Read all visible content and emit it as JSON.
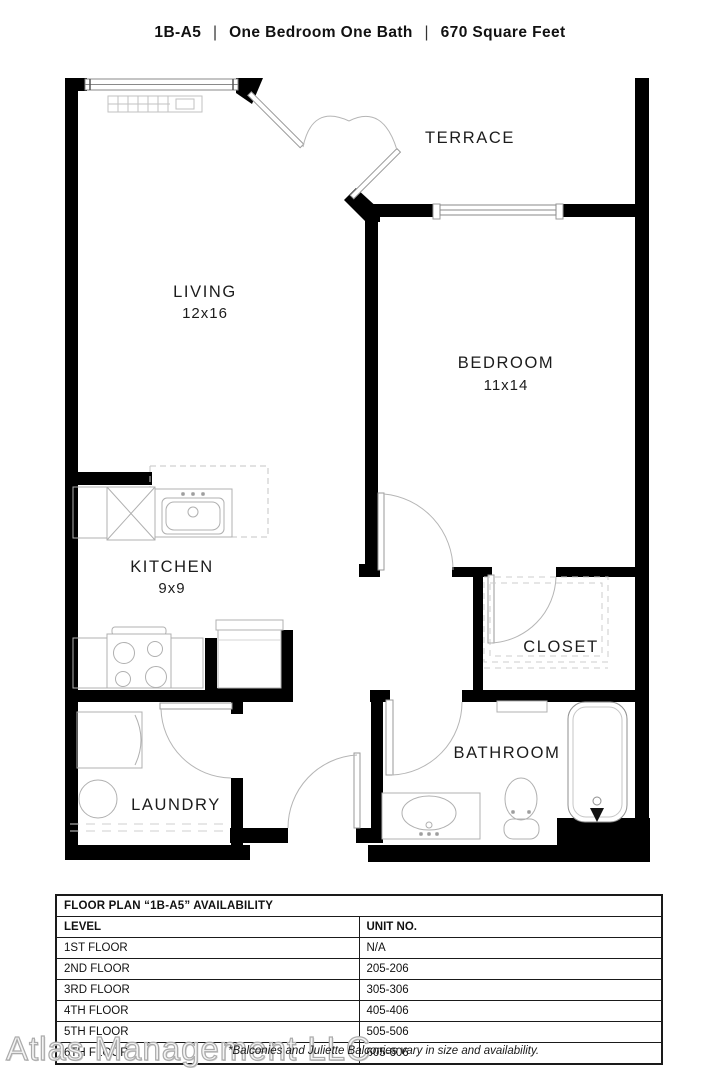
{
  "header": {
    "unit": "1B-A5",
    "separator": "|",
    "descriptor": "One Bedroom One Bath",
    "sqft": "670 Square Feet"
  },
  "floor_plan": {
    "terrace": {
      "name": "TERRACE"
    },
    "living": {
      "name": "LIVING",
      "dims": "12x16"
    },
    "bedroom": {
      "name": "BEDROOM",
      "dims": "11x14"
    },
    "kitchen": {
      "name": "KITCHEN",
      "dims": "9x9"
    },
    "closet": {
      "name": "CLOSET"
    },
    "bathroom": {
      "name": "BATHROOM"
    },
    "laundry": {
      "name": "LAUNDRY"
    },
    "wall_color": "#000000",
    "fixture_line_color": "#b0b0b0",
    "door_arc_color": "#aaaaaa"
  },
  "availability_table": {
    "title": "FLOOR PLAN “1B-A5” AVAILABILITY",
    "columns": [
      "LEVEL",
      "UNIT NO."
    ],
    "rows": [
      {
        "level": "1ST FLOOR",
        "unit": "N/A"
      },
      {
        "level": "2ND FLOOR",
        "unit": "205-206"
      },
      {
        "level": "3RD FLOOR",
        "unit": "305-306"
      },
      {
        "level": "4TH FLOOR",
        "unit": "405-406"
      },
      {
        "level": "5TH FLOOR",
        "unit": "505-506"
      },
      {
        "level": "6TH FLOOR",
        "unit": "605-606"
      }
    ]
  },
  "footer": {
    "watermark": "Atlas Management LLC",
    "disclaimer": "*Balconies and Juliette Balconies vary in size and availability."
  }
}
